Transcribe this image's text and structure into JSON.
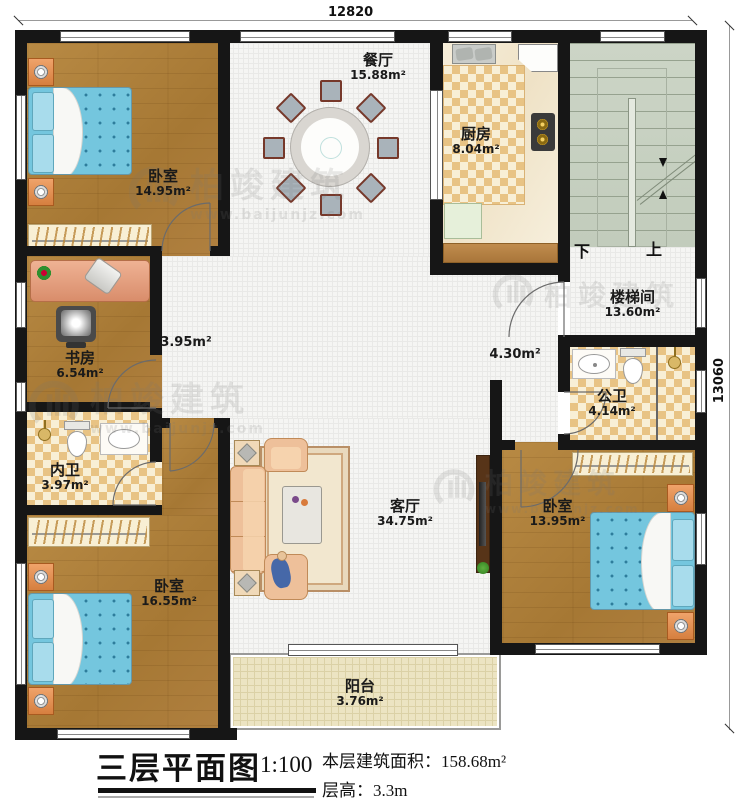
{
  "title_block": {
    "title": "三层平面图",
    "scale": "1:100",
    "building_area": "本层建筑面积：158.68m²",
    "floor_height": "层高：3.3m"
  },
  "dimensions": {
    "width": "12820",
    "height": "13060"
  },
  "watermark": {
    "brand": "柏竣建筑",
    "url": "www.baijunjz.com"
  },
  "stairs": {
    "down": "下",
    "up": "上"
  },
  "rooms": {
    "bedroom_tl": {
      "name": "卧室",
      "area": "14.95m²"
    },
    "dining": {
      "name": "餐厅",
      "area": "15.88m²"
    },
    "kitchen": {
      "name": "厨房",
      "area": "8.04m²"
    },
    "stairwell": {
      "name": "楼梯间",
      "area": "13.60m²"
    },
    "study": {
      "name": "书房",
      "area": "6.54m²"
    },
    "bath_inner": {
      "name": "内卫",
      "area": "3.97m²"
    },
    "bath_public": {
      "name": "公卫",
      "area": "4.14m²"
    },
    "living": {
      "name": "客厅",
      "area": "34.75m²"
    },
    "bedroom_bl": {
      "name": "卧室",
      "area": "16.55m²"
    },
    "bedroom_br": {
      "name": "卧室",
      "area": "13.95m²"
    },
    "balcony": {
      "name": "阳台",
      "area": "3.76m²"
    },
    "hall_west": {
      "area": "3.95m²"
    },
    "hall_east": {
      "area": "4.30m²"
    }
  }
}
